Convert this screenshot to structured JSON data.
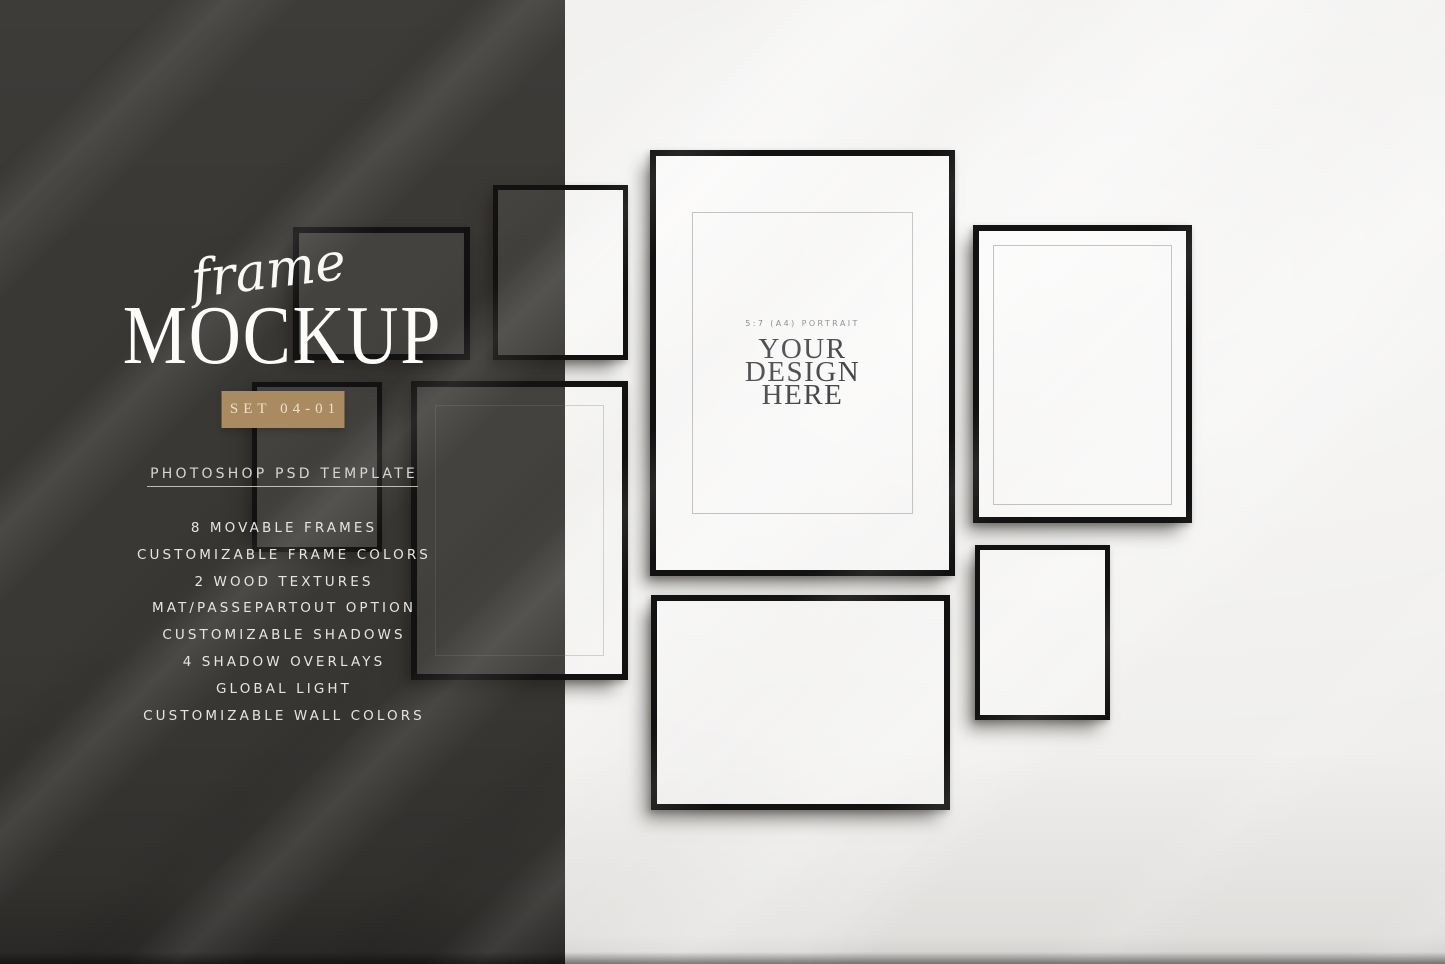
{
  "header": {
    "script_title": "frame",
    "main_title": "MOCKUP",
    "badge_label": "SET 04-01",
    "subtitle": "PHOTOSHOP PSD TEMPLATE"
  },
  "features": [
    "8 MOVABLE FRAMES",
    "CUSTOMIZABLE FRAME COLORS",
    "2 WOOD TEXTURES",
    "MAT/PASSEPARTOUT OPTION",
    "CUSTOMIZABLE SHADOWS",
    "4 SHADOW OVERLAYS",
    "GLOBAL LIGHT",
    "CUSTOMIZABLE WALL COLORS"
  ],
  "poster": {
    "size_label": "5:7 (A4) PORTRAIT",
    "design_lines": [
      "YOUR",
      "DESIGN",
      "HERE"
    ]
  },
  "colors": {
    "panel_bg": "#3a3835",
    "wall_bg": "#efeeec",
    "badge_bg": "#a98a61",
    "badge_text": "#eee0c8",
    "frame_border": "#121212",
    "title_text": "#fcfcfb",
    "subtitle_text": "#d8d6d4",
    "feature_text": "#e6e4e2",
    "poster_text": "#47474b",
    "poster_label_text": "#8b8b8d"
  }
}
